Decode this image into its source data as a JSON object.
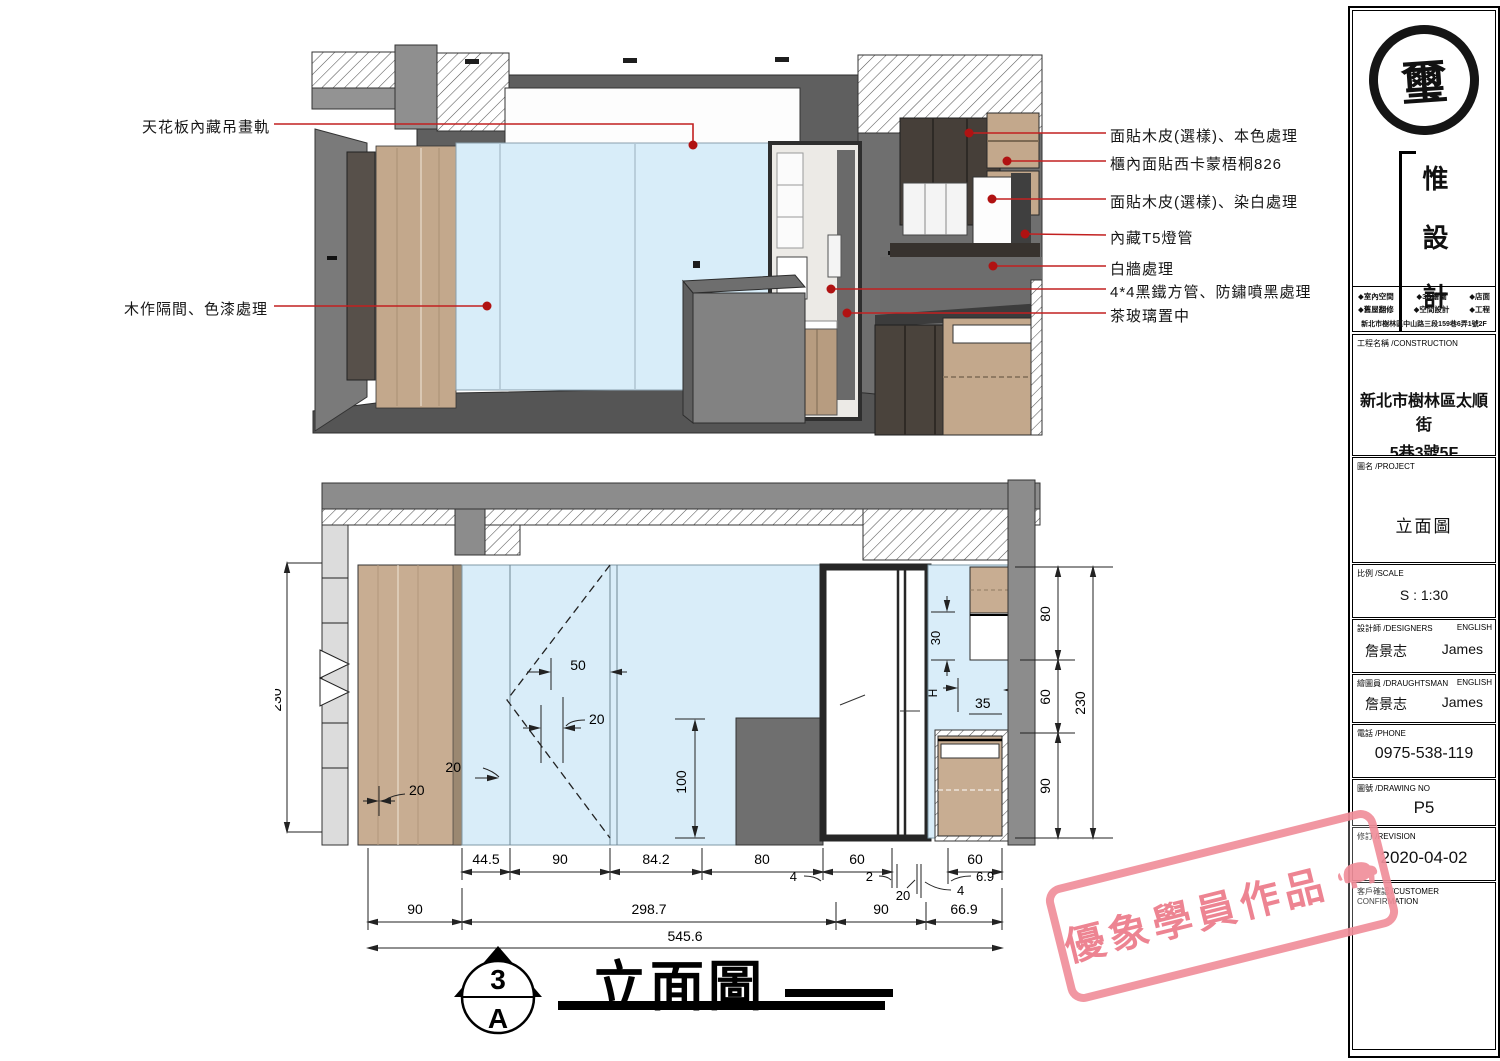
{
  "colors": {
    "glass_blue": "#d9edf9",
    "leader_red": "#c22020",
    "dot_red": "#b01212",
    "stamp_pink": "#ee8693",
    "wall_gray": "#8c8c8c",
    "wood": "#c8ad92"
  },
  "annotations": {
    "left": [
      "天花板內藏吊畫軌",
      "木作隔間、色漆處理"
    ],
    "right": [
      "面貼木皮(選樣)、本色處理",
      "櫃內面貼西卡蒙梧桐826",
      "面貼木皮(選樣)、染白處理",
      "內藏T5燈管",
      "白牆處理",
      "4*4黑鐵方管、防鏽噴黑處理",
      "茶玻璃置中"
    ]
  },
  "elev": {
    "r1": [
      "44.5",
      "90",
      "84.2",
      "80",
      "60",
      "60"
    ],
    "r1_callouts": [
      "4",
      "2",
      "20",
      "4",
      "6.9"
    ],
    "r2": [
      "90",
      "298.7",
      "90",
      "66.9"
    ],
    "total": "545.6",
    "h_left": "230",
    "h_right": [
      "80",
      "60",
      "90"
    ],
    "h_right_total": "230",
    "inner": {
      "d50": "50",
      "d20a": "20",
      "d20b": "20",
      "d20c": "20",
      "d100": "100",
      "d30": "30",
      "dH": "H",
      "d35": "35"
    },
    "title": "立面圖",
    "sym_num": "3",
    "sym_letter": "A"
  },
  "title_block": {
    "logo": {
      "seal": "璽",
      "brand": [
        "惟",
        "設",
        "計"
      ]
    },
    "services": [
      [
        "◆室內空間",
        "◆3D繪圖",
        "◆店面"
      ],
      [
        "◆舊屋翻修",
        "◆空間設計",
        "◆工程"
      ]
    ],
    "address": "新北市樹林區中山路三段159巷6弄1號2F",
    "construction": {
      "label": "工程名稱 /CONSTRUCTION",
      "line1": "新北市樹林區太順街",
      "line2": "5巷3號5F"
    },
    "project": {
      "label": "圖名 /PROJECT",
      "value": "立面圖"
    },
    "scale": {
      "label": "比例 /SCALE",
      "value": "S : 1:30"
    },
    "designers": {
      "label": "設計師 /DESIGNERS",
      "english": "ENGLISH",
      "name": "詹景志",
      "en_name": "James"
    },
    "draughtsman": {
      "label": "繪圖員 /DRAUGHTSMAN",
      "english": "ENGLISH",
      "name": "詹景志",
      "en_name": "James"
    },
    "phone": {
      "label": "電話 /PHONE",
      "value": "0975-538-119"
    },
    "drawing_no": {
      "label": "圖號 /DRAWING NO",
      "value": "P5"
    },
    "revision": {
      "label": "修訂 /REVISION",
      "value": "2020-04-02"
    },
    "customer": {
      "label": "客戶確認 /CUSTOMER CONFIRMATION"
    }
  },
  "stamp": {
    "text": "優象學員作品"
  }
}
